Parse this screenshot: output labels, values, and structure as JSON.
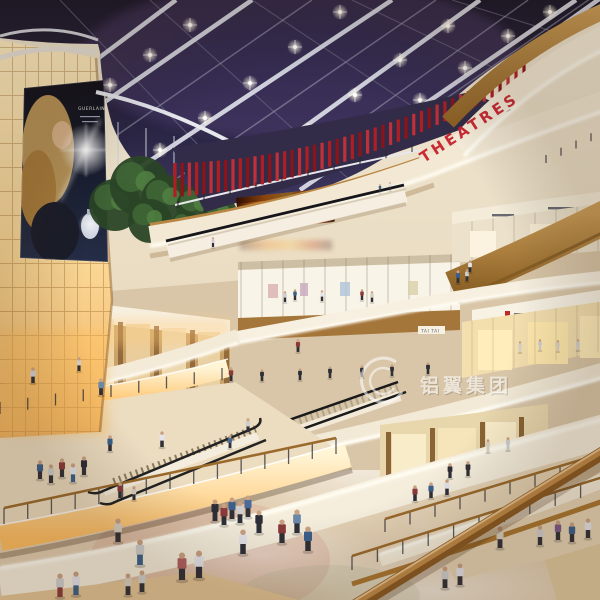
{
  "signs": {
    "theatres": "THEATRES",
    "tai_tai": "TAI TAI"
  },
  "watermark": {
    "text": "铝翼集团"
  },
  "billboard": {
    "brand": "GUERLAIN"
  },
  "colors": {
    "accent_red": "#c8202c",
    "wood": "#b5813a",
    "warm_glow": "#ffc069",
    "ceiling_dark": "#221d36",
    "cream": "#f2e8d4"
  },
  "scene": {
    "palette": [
      "#3a5f8a",
      "#8a3a3a",
      "#cfcfcf",
      "#2f2f38",
      "#d8d0c0",
      "#5a7a4a",
      "#7a5a8a",
      "#e4e4ea",
      "#4a6a9a",
      "#303036",
      "#b06060",
      "#6a88a8"
    ],
    "lamps": [
      [
        110,
        85
      ],
      [
        150,
        55
      ],
      [
        190,
        25
      ],
      [
        160,
        150
      ],
      [
        205,
        118
      ],
      [
        250,
        83
      ],
      [
        295,
        47
      ],
      [
        340,
        12
      ],
      [
        262,
        162
      ],
      [
        308,
        130
      ],
      [
        355,
        95
      ],
      [
        400,
        60
      ],
      [
        448,
        26
      ],
      [
        420,
        100
      ],
      [
        465,
        68
      ],
      [
        508,
        36
      ],
      [
        550,
        12
      ]
    ],
    "fins": {
      "ax": 175,
      "ay": 163,
      "cx": 340,
      "cy": 160,
      "bx": 524,
      "by": 64,
      "h1": 34,
      "h2": 16,
      "n": 47
    },
    "trees": [
      [
        115,
        205,
        26
      ],
      [
        140,
        186,
        30
      ],
      [
        166,
        200,
        25
      ],
      [
        150,
        221,
        22
      ],
      [
        197,
        207,
        21
      ],
      [
        220,
        213,
        17
      ],
      [
        186,
        226,
        15
      ]
    ],
    "posts": [
      [
        4,
        524,
        336,
        454,
        15,
        16,
        1
      ],
      [
        0,
        414,
        222,
        380,
        9,
        12,
        0
      ],
      [
        352,
        570,
        606,
        490,
        11,
        14,
        1
      ],
      [
        385,
        532,
        610,
        464,
        10,
        13,
        1
      ],
      [
        546,
        163,
        606,
        134,
        5,
        8,
        0
      ],
      [
        178,
        208,
        412,
        152,
        10,
        7,
        0
      ]
    ],
    "people": [
      [
        182,
        580,
        28,
        10,
        3
      ],
      [
        199,
        578,
        28,
        7,
        3
      ],
      [
        215,
        521,
        22,
        3,
        9
      ],
      [
        224,
        525,
        22,
        1,
        3
      ],
      [
        232,
        519,
        22,
        0,
        9
      ],
      [
        240,
        523,
        22,
        2,
        3
      ],
      [
        248,
        517,
        22,
        8,
        9
      ],
      [
        259,
        533,
        23,
        3,
        3
      ],
      [
        282,
        543,
        24,
        1,
        9
      ],
      [
        297,
        533,
        24,
        11,
        3
      ],
      [
        308,
        551,
        25,
        0,
        9
      ],
      [
        243,
        554,
        25,
        7,
        3
      ],
      [
        140,
        565,
        26,
        2,
        0
      ],
      [
        118,
        542,
        24,
        4,
        9
      ],
      [
        60,
        597,
        24,
        2,
        1
      ],
      [
        76,
        595,
        24,
        7,
        0
      ],
      [
        128,
        595,
        22,
        4,
        3
      ],
      [
        142,
        592,
        22,
        2,
        9
      ],
      [
        40,
        479,
        19,
        0,
        3
      ],
      [
        51,
        483,
        19,
        2,
        9
      ],
      [
        62,
        477,
        19,
        1,
        3
      ],
      [
        73,
        482,
        19,
        7,
        0
      ],
      [
        84,
        475,
        19,
        3,
        9
      ],
      [
        33,
        383,
        16,
        2,
        3
      ],
      [
        79,
        371,
        14,
        4,
        9
      ],
      [
        101,
        395,
        17,
        11,
        3
      ],
      [
        231,
        381,
        14,
        1,
        3
      ],
      [
        110,
        451,
        16,
        0,
        9
      ],
      [
        162,
        447,
        16,
        7,
        3
      ],
      [
        248,
        432,
        14,
        2,
        3
      ],
      [
        230,
        448,
        13,
        8,
        9
      ],
      [
        120,
        498,
        16,
        1,
        3
      ],
      [
        134,
        500,
        14,
        4,
        9
      ],
      [
        285,
        302,
        11,
        2,
        3
      ],
      [
        295,
        300,
        11,
        0,
        9
      ],
      [
        322,
        301,
        11,
        7,
        3
      ],
      [
        362,
        300,
        11,
        1,
        9
      ],
      [
        372,
        302,
        11,
        4,
        3
      ],
      [
        262,
        381,
        12,
        9,
        9
      ],
      [
        300,
        380,
        12,
        3,
        3
      ],
      [
        330,
        378,
        12,
        9,
        9
      ],
      [
        362,
        377,
        12,
        3,
        3
      ],
      [
        392,
        376,
        12,
        9,
        9
      ],
      [
        428,
        374,
        12,
        3,
        3
      ],
      [
        520,
        352,
        11,
        4,
        4
      ],
      [
        540,
        350,
        11,
        2,
        2
      ],
      [
        558,
        351,
        11,
        4,
        4
      ],
      [
        578,
        350,
        11,
        2,
        2
      ],
      [
        450,
        478,
        15,
        3,
        3
      ],
      [
        468,
        476,
        15,
        9,
        9
      ],
      [
        488,
        452,
        13,
        4,
        4
      ],
      [
        508,
        450,
        13,
        2,
        2
      ],
      [
        540,
        545,
        20,
        2,
        3
      ],
      [
        558,
        540,
        20,
        6,
        9
      ],
      [
        572,
        542,
        20,
        0,
        3
      ],
      [
        588,
        538,
        20,
        7,
        9
      ],
      [
        500,
        548,
        22,
        4,
        3
      ],
      [
        445,
        588,
        22,
        2,
        9
      ],
      [
        460,
        585,
        22,
        7,
        3
      ],
      [
        415,
        501,
        16,
        1,
        3
      ],
      [
        431,
        498,
        16,
        0,
        9
      ],
      [
        447,
        495,
        16,
        7,
        3
      ],
      [
        458,
        283,
        13,
        0,
        3
      ],
      [
        467,
        281,
        12,
        2,
        9
      ],
      [
        470,
        272,
        12,
        7,
        3
      ],
      [
        213,
        247,
        10,
        2,
        3
      ],
      [
        390,
        190,
        8,
        7,
        9
      ],
      [
        380,
        192,
        8,
        0,
        3
      ],
      [
        298,
        352,
        13,
        1,
        3
      ]
    ]
  }
}
